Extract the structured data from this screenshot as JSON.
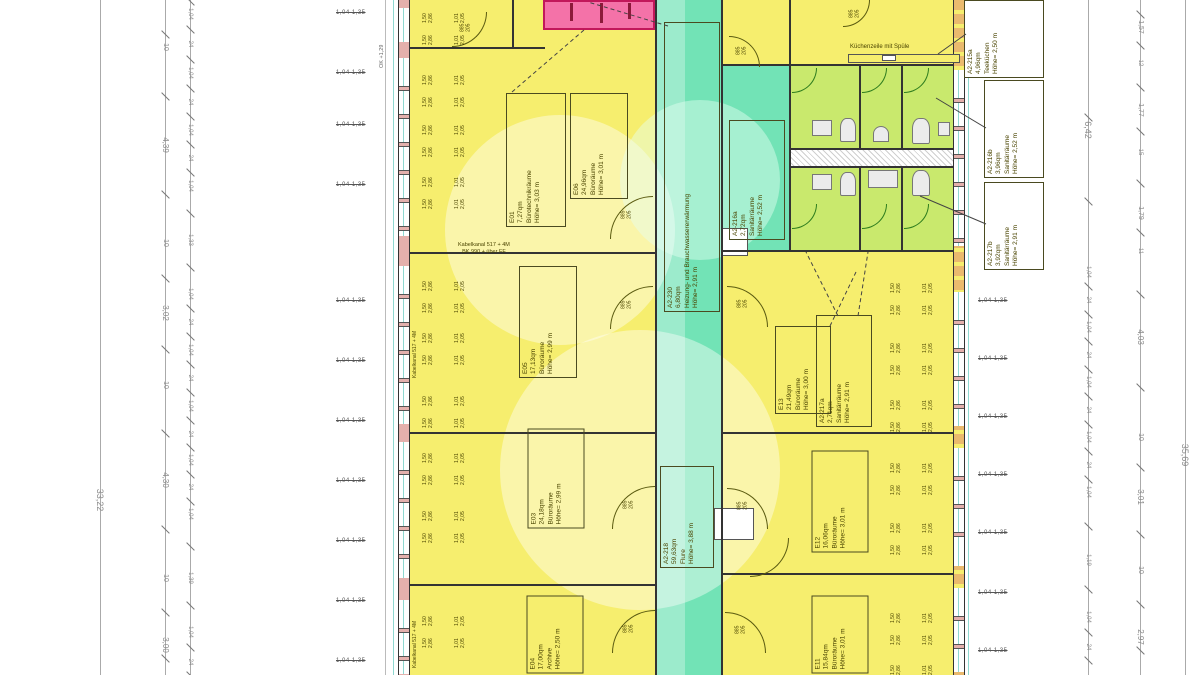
{
  "colors": {
    "room_yellow": "#f6ee6e",
    "corridor_teal": "#72e3b6",
    "sanitary_green": "#c9e96d",
    "stair_pink": "#f472a8",
    "wall_fill_left": "#e4b0ac",
    "wall_fill_right": "#eaba6e",
    "label_ink": "#4a4400",
    "dimension_gray": "#8a8a8a",
    "wall_line": "#333333",
    "door_arc": "#5a5a10",
    "sanitary_door_arc": "#2f7d1e",
    "glazing_cyan": "#8fd8d0"
  },
  "room_labels": [
    {
      "id": "e01",
      "lines": [
        "E01",
        "7,27qm",
        "Bürotechnikräume",
        "Höhe= 3,03 m"
      ]
    },
    {
      "id": "e06",
      "lines": [
        "E06",
        "24,96qm",
        "Büroräume",
        "Höhe= 3,01 m"
      ]
    },
    {
      "id": "e05",
      "lines": [
        "E05",
        "17,13qm",
        "Büroräume",
        "Höhe= 2,99 m"
      ]
    },
    {
      "id": "e03",
      "lines": [
        "E03",
        "24,18qm",
        "Büroräume",
        "Höhe= 2,99 m"
      ]
    },
    {
      "id": "e04",
      "lines": [
        "E04",
        "17,00qm",
        "Archive",
        "Höhe= 2,50 m"
      ]
    },
    {
      "id": "e13",
      "lines": [
        "E13",
        "21,49qm",
        "Büroräume",
        "Höhe= 3,00 m"
      ]
    },
    {
      "id": "e12",
      "lines": [
        "E12",
        "16,06qm",
        "Büroräume",
        "Höhe= 3,01 m"
      ]
    },
    {
      "id": "e11",
      "lines": [
        "E11",
        "15,84qm",
        "Büroräume",
        "Höhe= 3,01 m"
      ]
    },
    {
      "id": "flur",
      "lines": [
        "A2-218",
        "59,63qm",
        "Flure",
        "Höhe= 3,88 m"
      ]
    },
    {
      "id": "heizung",
      "lines": [
        "A2-230",
        "6,80qm",
        "Heizung- und Brauchwassererwärmung",
        "Höhe= 2,91 m"
      ]
    },
    {
      "id": "s216a",
      "lines": [
        "A2-216a",
        "2,72qm",
        "Sanitärräume",
        "Höhe= 2,52 m"
      ]
    },
    {
      "id": "s217a",
      "lines": [
        "A2-217a",
        "2,71qm",
        "Sanitärräume",
        "Höhe= 2,91 m"
      ]
    },
    {
      "id": "tee",
      "lines": [
        "A2-215a",
        "4,96qm",
        "Teeküchen",
        "Höhe= 2,50 m"
      ]
    },
    {
      "id": "s216b",
      "lines": [
        "A2-216b",
        "3,96qm",
        "Sanitärräume",
        "Höhe= 2,52 m"
      ]
    },
    {
      "id": "s217b",
      "lines": [
        "A2-217b",
        "3,92qm",
        "Sanitärräume",
        "Höhe= 2,91 m"
      ]
    }
  ],
  "dim_lines": {
    "left": [
      {
        "name": "total-left",
        "x": 100,
        "labels": [
          {
            "v": "33,22",
            "y": 500,
            "s": 9
          }
        ]
      },
      {
        "name": "rooms-left",
        "x": 165,
        "labels": [
          {
            "v": "10",
            "y": 47,
            "s": 7
          },
          {
            "v": "4,39",
            "y": 145,
            "s": 8
          },
          {
            "v": "10",
            "y": 243,
            "s": 7
          },
          {
            "v": "3,02",
            "y": 313,
            "s": 8
          },
          {
            "v": "10",
            "y": 385,
            "s": 7
          },
          {
            "v": "4,30",
            "y": 480,
            "s": 8
          },
          {
            "v": "10",
            "y": 578,
            "s": 7
          },
          {
            "v": "3,00",
            "y": 645,
            "s": 8
          }
        ]
      },
      {
        "name": "windows-left",
        "x": 190,
        "labels": [
          {
            "v": "1,04",
            "y": 14,
            "s": 6
          },
          {
            "v": "24",
            "y": 44,
            "s": 6
          },
          {
            "v": "1,04",
            "y": 73,
            "s": 6
          },
          {
            "v": "24",
            "y": 102,
            "s": 6
          },
          {
            "v": "1,04",
            "y": 130,
            "s": 6
          },
          {
            "v": "24",
            "y": 158,
            "s": 6
          },
          {
            "v": "1,04",
            "y": 186,
            "s": 6
          },
          {
            "v": "1,33",
            "y": 240,
            "s": 6
          },
          {
            "v": "1,04",
            "y": 294,
            "s": 6
          },
          {
            "v": "24",
            "y": 322,
            "s": 6
          },
          {
            "v": "1,04",
            "y": 350,
            "s": 6
          },
          {
            "v": "24",
            "y": 378,
            "s": 6
          },
          {
            "v": "1,04",
            "y": 406,
            "s": 6
          },
          {
            "v": "24",
            "y": 434,
            "s": 6
          },
          {
            "v": "1,04",
            "y": 460,
            "s": 6
          },
          {
            "v": "24",
            "y": 487,
            "s": 6
          },
          {
            "v": "1,04",
            "y": 514,
            "s": 6
          },
          {
            "v": "1,39",
            "y": 578,
            "s": 6
          },
          {
            "v": "1,04",
            "y": 632,
            "s": 6
          },
          {
            "v": "24",
            "y": 662,
            "s": 6
          }
        ]
      }
    ],
    "right": [
      {
        "name": "windows-right",
        "x": 1088,
        "labels": [
          {
            "v": "6,42",
            "y": 130,
            "s": 9
          },
          {
            "v": "1,04",
            "y": 272,
            "s": 6
          },
          {
            "v": "24",
            "y": 300,
            "s": 6
          },
          {
            "v": "1,04",
            "y": 327,
            "s": 6
          },
          {
            "v": "24",
            "y": 355,
            "s": 6
          },
          {
            "v": "1,04",
            "y": 382,
            "s": 6
          },
          {
            "v": "24",
            "y": 410,
            "s": 6
          },
          {
            "v": "1,04",
            "y": 437,
            "s": 6
          },
          {
            "v": "24",
            "y": 465,
            "s": 6
          },
          {
            "v": "1,04",
            "y": 492,
            "s": 6
          },
          {
            "v": "1,19",
            "y": 560,
            "s": 6
          },
          {
            "v": "1,04",
            "y": 617,
            "s": 6
          },
          {
            "v": "24",
            "y": 647,
            "s": 6
          }
        ]
      },
      {
        "name": "rooms-right",
        "x": 1140,
        "labels": [
          {
            "v": "1,57",
            "y": 27,
            "s": 7
          },
          {
            "v": "12",
            "y": 63,
            "s": 6
          },
          {
            "v": "1,77",
            "y": 110,
            "s": 7
          },
          {
            "v": "15",
            "y": 152,
            "s": 6
          },
          {
            "v": "1,79",
            "y": 213,
            "s": 7
          },
          {
            "v": "11",
            "y": 251,
            "s": 6
          },
          {
            "v": "4,03",
            "y": 337,
            "s": 8
          },
          {
            "v": "10",
            "y": 437,
            "s": 7
          },
          {
            "v": "3,01",
            "y": 497,
            "s": 8
          },
          {
            "v": "10",
            "y": 570,
            "s": 7
          },
          {
            "v": "2,97",
            "y": 637,
            "s": 8
          }
        ]
      },
      {
        "name": "total-right",
        "x": 1185,
        "labels": [
          {
            "v": "35,69",
            "y": 455,
            "s": 9
          }
        ]
      }
    ]
  },
  "texts": {
    "kitchen": "Küchenzeile mit Spüle",
    "cable_channel_line1": "Kabelkanal 517 + 4M",
    "cable_channel_line2": "BK 990 + über FF",
    "wall_note": "Kabelkanal 517 + 4M",
    "level_mark": "OK +1,29"
  },
  "door_tag": {
    "width": "885",
    "height": "205"
  },
  "window_tag_pair": {
    "a": "1,04",
    "b": "1,35"
  },
  "interior_window_tags": {
    "a": "1,50",
    "b": "2,86",
    "c": "1,01",
    "d": "2,05"
  }
}
